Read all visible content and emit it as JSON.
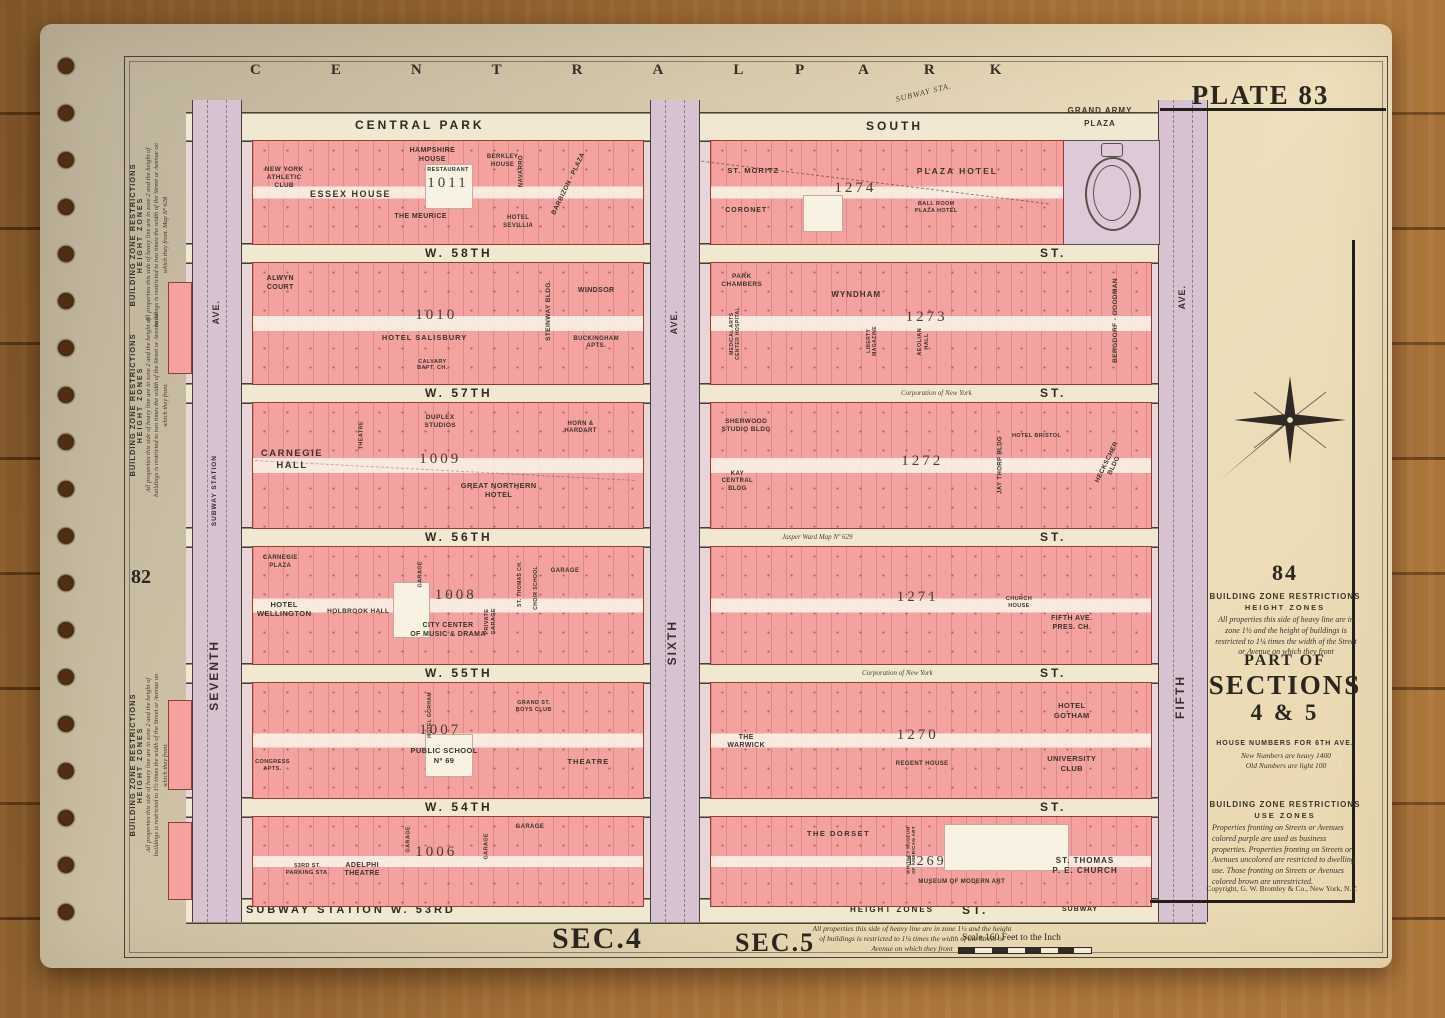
{
  "palette": {
    "wood": "#9a672f",
    "paper": "#ece4c8",
    "block_pink": "#f3a2a0",
    "avenue_lavender": "#d7c2d2",
    "street_cream": "#f0e8d0",
    "frontage_tint": "#e7d5d8",
    "lot_line_red": "#9c3a30",
    "ink": "#35302a"
  },
  "park": {
    "title_left": "CENTRAL",
    "title_right": "PARK",
    "subway_sta": "SUBWAY STA."
  },
  "plate": {
    "label": "PLATE 83"
  },
  "header": {
    "cps_left": "CENTRAL PARK",
    "cps_right": "SOUTH",
    "grand_army_1": "GRAND ARMY",
    "grand_army_2": "PLAZA"
  },
  "streets": {
    "w58": "W. 58TH",
    "w57": "W. 57TH",
    "w56": "W. 56TH",
    "w55": "W. 55TH",
    "w54": "W. 54TH",
    "w53": "SUBWAY STATION W. 53RD",
    "st": "ST.",
    "corp": "Corporation of New York",
    "jasper": "Jasper Ward Map Nº 629",
    "height_zones": "HEIGHT ZONES",
    "subway_small": "SUBWAY"
  },
  "avenues": {
    "seventh": "SEVENTH",
    "sixth": "SIXTH",
    "fifth": "FIFTH",
    "ave": "AVE.",
    "subway_station": "SUBWAY STATION"
  },
  "blocks": {
    "b1011": {
      "number": "1011",
      "nyac": "NEW YORK\nATHLETIC\nCLUB",
      "essex": "ESSEX HOUSE",
      "hampshire": "HAMPSHIRE\nHOUSE",
      "restaurant": "RESTAURANT",
      "meurice": "THE MEURICE",
      "berkley": "BERKLEY\nHOUSE",
      "navarro": "NAVARRO",
      "barbizon": "BARBIZON - PLAZA",
      "sevillia": "HOTEL\nSEVILLIA"
    },
    "b1274": {
      "number": "1274",
      "st_moritz": "ST. MORITZ",
      "coronet": "CORONET",
      "plaza_hotel": "PLAZA HOTEL",
      "ballroom": "BALL ROOM\nPLAZA HOTEL"
    },
    "b1010": {
      "number": "1010",
      "alwyn": "ALWYN\nCOURT",
      "salisbury": "HOTEL SALISBURY",
      "calvary": "CALVARY\nBAPT. CH.",
      "steinway": "STEINWAY BLDG.",
      "windsor": "WINDSOR",
      "buckingham": "BUCKINGHAM\nAPTS."
    },
    "b1273": {
      "number": "1273",
      "chambers": "PARK\nCHAMBERS",
      "medical": "MEDICAL ARTS\nCENTER HOSPITAL",
      "wyndham": "WYNDHAM",
      "liberty": "LIBERTY\nMAGAZINE",
      "aeolian": "AEOLIAN\nHALL",
      "bergdorf": "BERGDORF - GOODMAN"
    },
    "b1009": {
      "number": "1009",
      "carnegie": "CARNEGIE\nHALL",
      "theatre": "THEATRE",
      "duplex": "DUPLEX\nSTUDIOS",
      "horn": "HORN &\nHARDART",
      "great_northern": "GREAT NORTHERN\nHOTEL"
    },
    "b1272": {
      "number": "1272",
      "sherwood": "SHERWOOD\nSTUDIO BLDG",
      "kay": "KAY\nCENTRAL\nBLDG",
      "bristol": "HOTEL BRISTOL",
      "jay_thorp": "JAY THORP BLDG",
      "heckscher": "HECKSCHER BLDG"
    },
    "b1008": {
      "number": "1008",
      "carnegie_plaza": "CARNEGIE\nPLAZA",
      "wellington": "HOTEL\nWELLINGTON",
      "holbrook": "HOLBROOK HALL",
      "garage_a": "GARAGE",
      "city_center": "CITY CENTER\nOF MUSIC & DRAMA",
      "private_garage": "PRIVATE\nGARAGE",
      "st_thomas_ch": "ST. THOMAS CH.",
      "choir": "CHOIR SCHOOL",
      "garage_b": "GARAGE"
    },
    "b1271": {
      "number": "1271",
      "church_house": "CHURCH\nHOUSE",
      "fifth_pres": "FIFTH AVE.\nPRES. CH."
    },
    "b1007": {
      "number": "1007",
      "congress": "CONGRESS\nAPTS.",
      "gorham": "HOTEL GORHAM",
      "public_school": "PUBLIC SCHOOL\nNº 69",
      "boys_club": "GRAND ST.\nBOYS CLUB",
      "theatre": "THEATRE"
    },
    "b1270": {
      "number": "1270",
      "warwick": "THE\nWARWICK",
      "regent": "REGENT HOUSE",
      "gotham": "HOTEL\nGOTHAM",
      "university": "UNIVERSITY\nCLUB"
    },
    "b1006": {
      "number": "1006",
      "parking": "53RD ST.\nPARKING STA.",
      "adelphi": "ADELPHI\nTHEATRE",
      "garage_a": "GARAGE",
      "garage_b": "GARAGE",
      "garage_c": "GARAGE"
    },
    "b1269": {
      "number": "1269",
      "dorset": "THE DORSET",
      "whitney": "WHITNEY MUSEUM\nOF AMERICAN ART",
      "moma": "MUSEUM OF MODERN ART",
      "st_thomas": "ST. THOMAS\nP. E. CHURCH"
    }
  },
  "margin_left": {
    "heading": "BUILDING ZONE RESTRICTIONS",
    "sub": "HEIGHT ZONES",
    "body1": "All properties this side of heavy line are in zone 2 and the height of buildings is restricted to two times the width of the Street or Avenue on which they front.  Map Nº 628",
    "body2": "All properties this side of heavy line are in zone 2 and the height of buildings is restricted to two times the width of the Street or Avenue on which they front.",
    "body3": "All properties this side of heavy line are in zone 2 and the height of buildings is restricted to 1½ times the width of the Street or Avenue on which they front.",
    "section_82": "82"
  },
  "margin_right": {
    "section_84": "84",
    "bzr_heading": "BUILDING ZONE RESTRICTIONS",
    "bzr_sub": "HEIGHT ZONES",
    "bzr_body": "All properties this side of heavy line are in zone 1½ and the height of buildings is restricted to 1¼ times the width of the Street or Avenue on which they front",
    "part_of": "PART OF",
    "sections": "SECTIONS",
    "sections_num": "4 & 5",
    "house_heading": "HOUSE NUMBERS FOR 6TH AVE.",
    "house_1": "New Numbers are heavy  1400",
    "house_2": "Old Numbers are light  100",
    "use_heading": "BUILDING ZONE RESTRICTIONS",
    "use_sub": "USE ZONES",
    "use_body": "Properties fronting on Streets or Avenues colored purple are used as business properties. Properties fronting on Streets or Avenues uncolored are restricted to dwelling use. Those fronting on Streets or Avenues colored brown are unrestricted.",
    "copyright": "Copyright, G. W. Bromley & Co., New York, N.Y."
  },
  "footer": {
    "sec4": "SEC.4",
    "sec5": "SEC.5",
    "height_body": "All properties this side of heavy line are in zone 1½ and the height of buildings is restricted to 1¼ times the width of the Street or Avenue on which they front",
    "scale": "Scale 160 Feet to the Inch"
  }
}
